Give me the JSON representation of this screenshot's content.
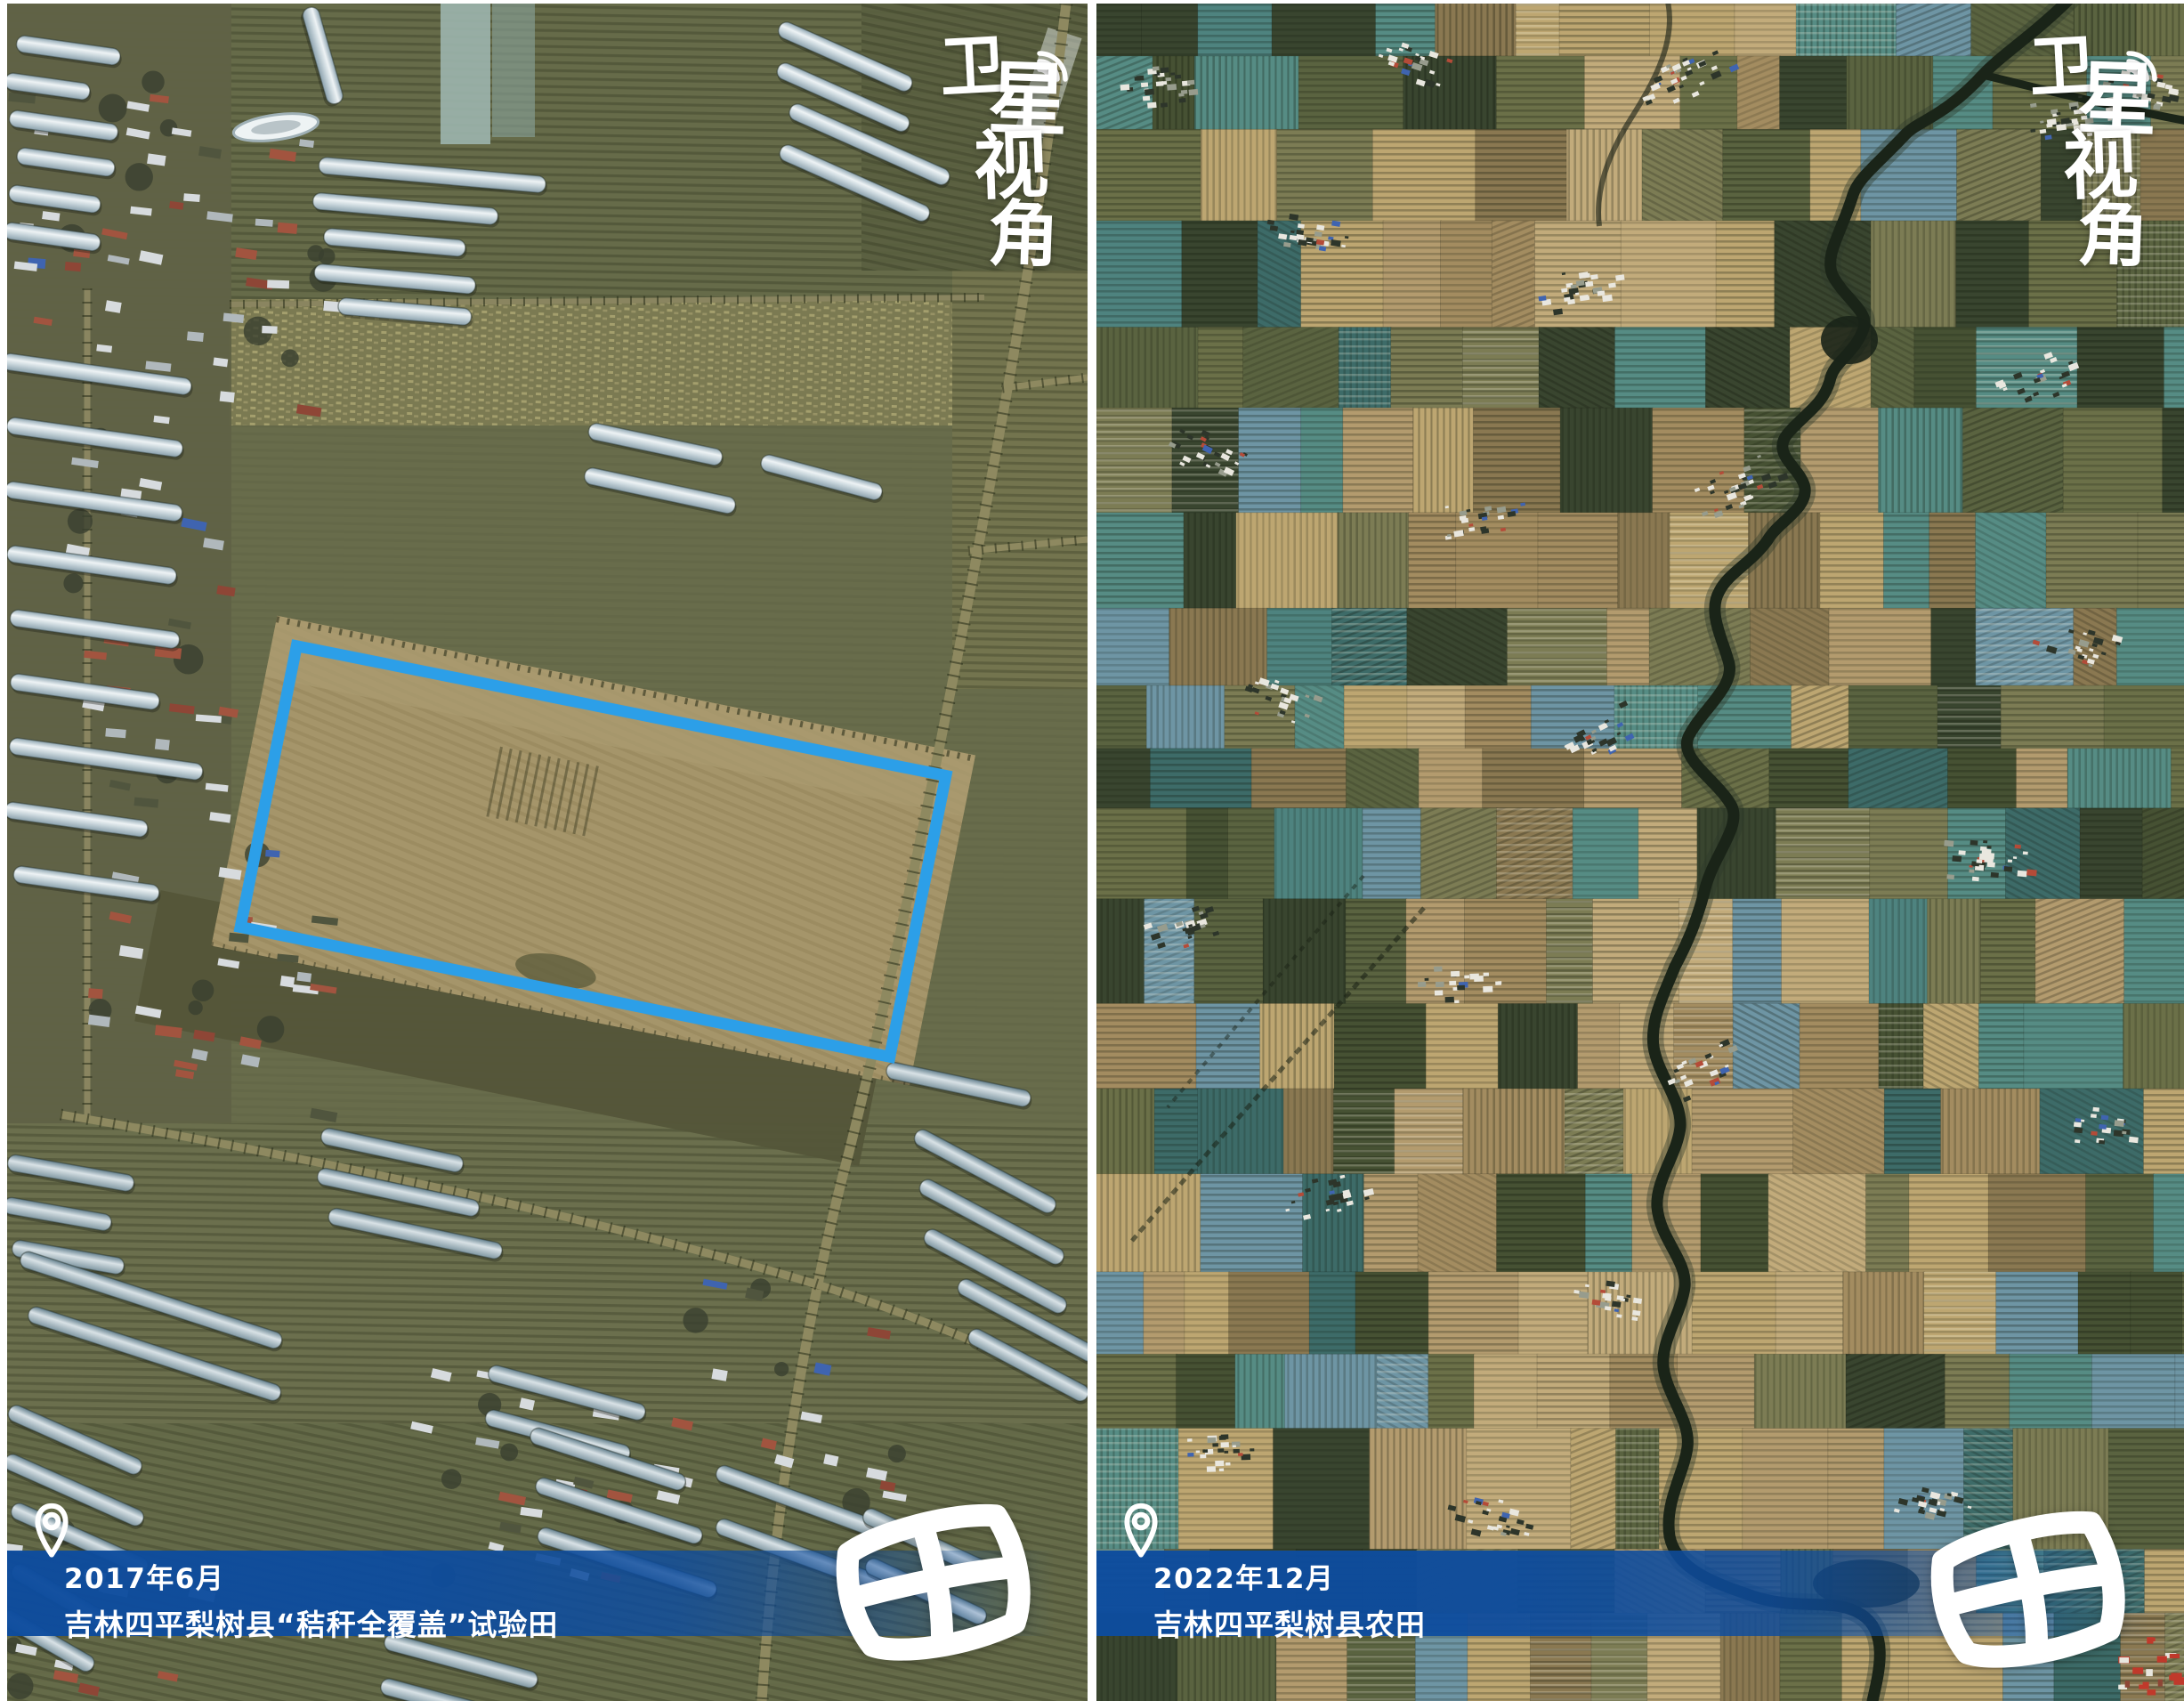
{
  "graphic": {
    "kind": "satellite-before-after-comparison"
  },
  "watermark": {
    "text": "卫星视角",
    "chars": [
      "卫",
      "星",
      "视",
      "角"
    ],
    "icon": "signal-waves-icon",
    "color": "#ffffff"
  },
  "logo": {
    "char": "田",
    "color": "#ffffff"
  },
  "colors": {
    "banner_blue": "#0d4c9e",
    "highlight_blue": "#2c9fe8",
    "divider_white": "#ffffff"
  },
  "panels": [
    {
      "id": "before",
      "date": "2017年6月",
      "caption": "吉林四平梨树县“秸秆全覆盖”试验田",
      "pin_icon": "location-pin-icon",
      "highlight_box": {
        "present": true,
        "color": "#2c9fe8"
      }
    },
    {
      "id": "after",
      "date": "2022年12月",
      "caption": "吉林四平梨树县农田",
      "pin_icon": "location-pin-icon",
      "highlight_box": {
        "present": false
      }
    }
  ]
}
